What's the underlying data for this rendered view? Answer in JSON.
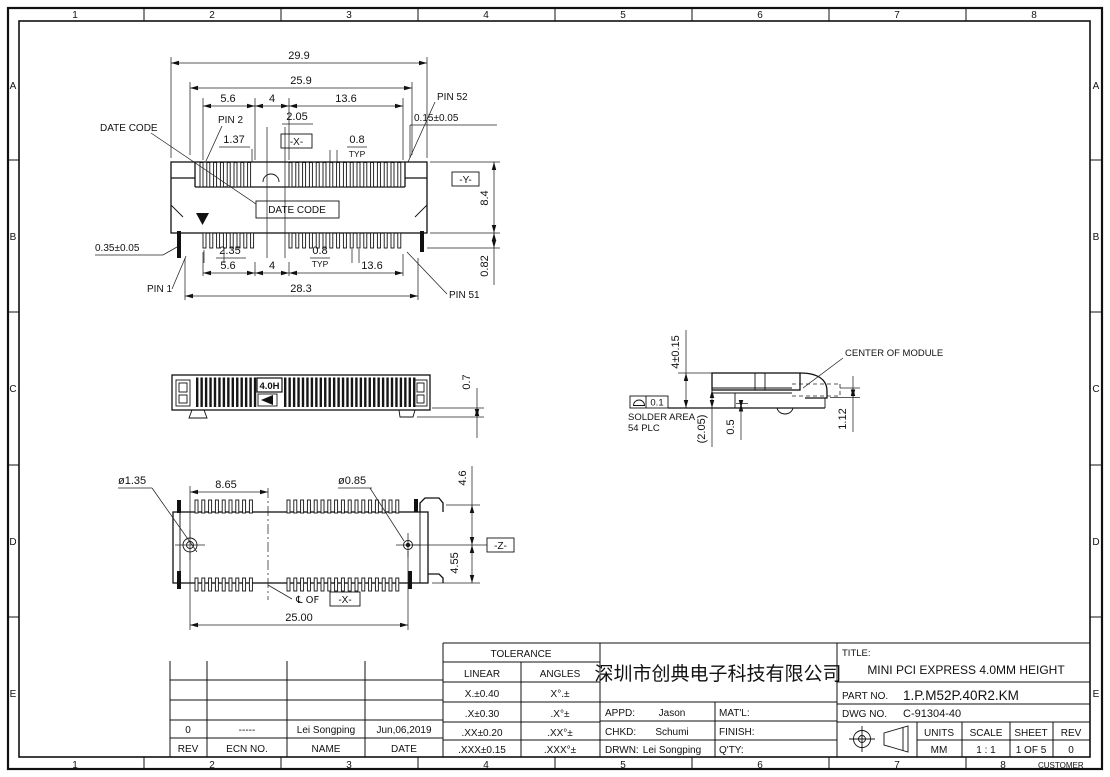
{
  "sheet": {
    "zone_columns": [
      "1",
      "2",
      "3",
      "4",
      "5",
      "6",
      "7",
      "8"
    ],
    "zone_rows": [
      "A",
      "B",
      "C",
      "D",
      "E"
    ],
    "customer_label": "CUSTOMER"
  },
  "top_view": {
    "dim_overall_width": "29.9",
    "dim_body_width": "25.9",
    "dim_seg_a": "5.6",
    "dim_seg_b": "4",
    "dim_seg_c": "13.6",
    "pin52_label": "PIN 52",
    "dim_pin_offset": "0.15±0.05",
    "date_code_label": "DATE CODE",
    "pin2_label": "PIN 2",
    "dim_key_width": "2.05",
    "dim_pin_width": "1.37",
    "datum_x": "-X-",
    "dim_pitch": "0.8",
    "typ_label": "TYP",
    "datum_y": "-Y-",
    "dim_depth": "8.4",
    "date_code_box": "DATE CODE",
    "dim_tail_width": "0.35±0.05",
    "dim_tail_a": "2.35",
    "dim_pitch_bottom": "0.8",
    "typ_label_bottom": "TYP",
    "dim_tail_protrusion": "0.82",
    "dim_seg_a_bottom": "5.6",
    "dim_seg_b_bottom": "4",
    "dim_seg_c_bottom": "13.6",
    "dim_tail_span": "28.3",
    "pin1_label": "PIN 1",
    "pin51_label": "PIN 51"
  },
  "front_view": {
    "height_code": "4.0H",
    "dim_standoff": "0.7"
  },
  "side_view": {
    "dim_height": "4±0.15",
    "center_of_module_label": "CENTER OF MODULE",
    "flatness_tolerance": "0.1",
    "solder_area_line1": "SOLDER AREA",
    "solder_area_line2": "54 PLC",
    "dim_ref_height": "(2.05)",
    "dim_standoff": "0.5",
    "dim_card_offset": "1.12"
  },
  "bottom_view": {
    "dia_hole_left": "ø1.35",
    "dim_hole_to_center": "8.65",
    "dia_hole_right": "ø0.85",
    "dim_upper": "4.6",
    "datum_z": "-Z-",
    "dim_lower": "4.55",
    "centerline_label": "℄ OF",
    "datum_x_ref": "-X-",
    "dim_hole_span": "25.00"
  },
  "revision_table": {
    "entry": {
      "rev": "0",
      "ecn_no": "-----",
      "name": "Lei Songping",
      "date": "Jun,06,2019"
    },
    "headers": {
      "rev": "REV",
      "ecn_no": "ECN NO.",
      "name": "NAME",
      "date": "DATE"
    }
  },
  "tolerance_table": {
    "title": "TOLERANCE",
    "linear_header": "LINEAR",
    "angles_header": "ANGLES",
    "rows": [
      [
        "X.±0.40",
        "X°.±"
      ],
      [
        ".X±0.30",
        ".X°±"
      ],
      [
        ".XX±0.20",
        ".XX°±"
      ],
      [
        ".XXX±0.15",
        ".XXX°±"
      ]
    ]
  },
  "company_block": {
    "company_name": "深圳市创典电子科技有限公司",
    "appd_label": "APPD:",
    "appd_value": "Jason",
    "matl_label": "MAT'L:",
    "chkd_label": "CHKD:",
    "chkd_value": "Schumi",
    "finish_label": "FINISH:",
    "drwn_label": "DRWN:",
    "drwn_value": "Lei Songping",
    "qty_label": "Q'TY:"
  },
  "title_block": {
    "title_label": "TITLE:",
    "title_value": "MINI PCI EXPRESS 4.0MM HEIGHT",
    "part_no_label": "PART NO.",
    "part_no_value": "1.P.M52P.40R2.KM",
    "dwg_no_label": "DWG NO.",
    "dwg_no_value": "C-91304-40",
    "units_label": "UNITS",
    "units_value": "MM",
    "scale_label": "SCALE",
    "scale_value": "1 : 1",
    "sheet_label": "SHEET",
    "sheet_value": "1 OF 5",
    "rev_label": "REV",
    "rev_value": "0"
  }
}
